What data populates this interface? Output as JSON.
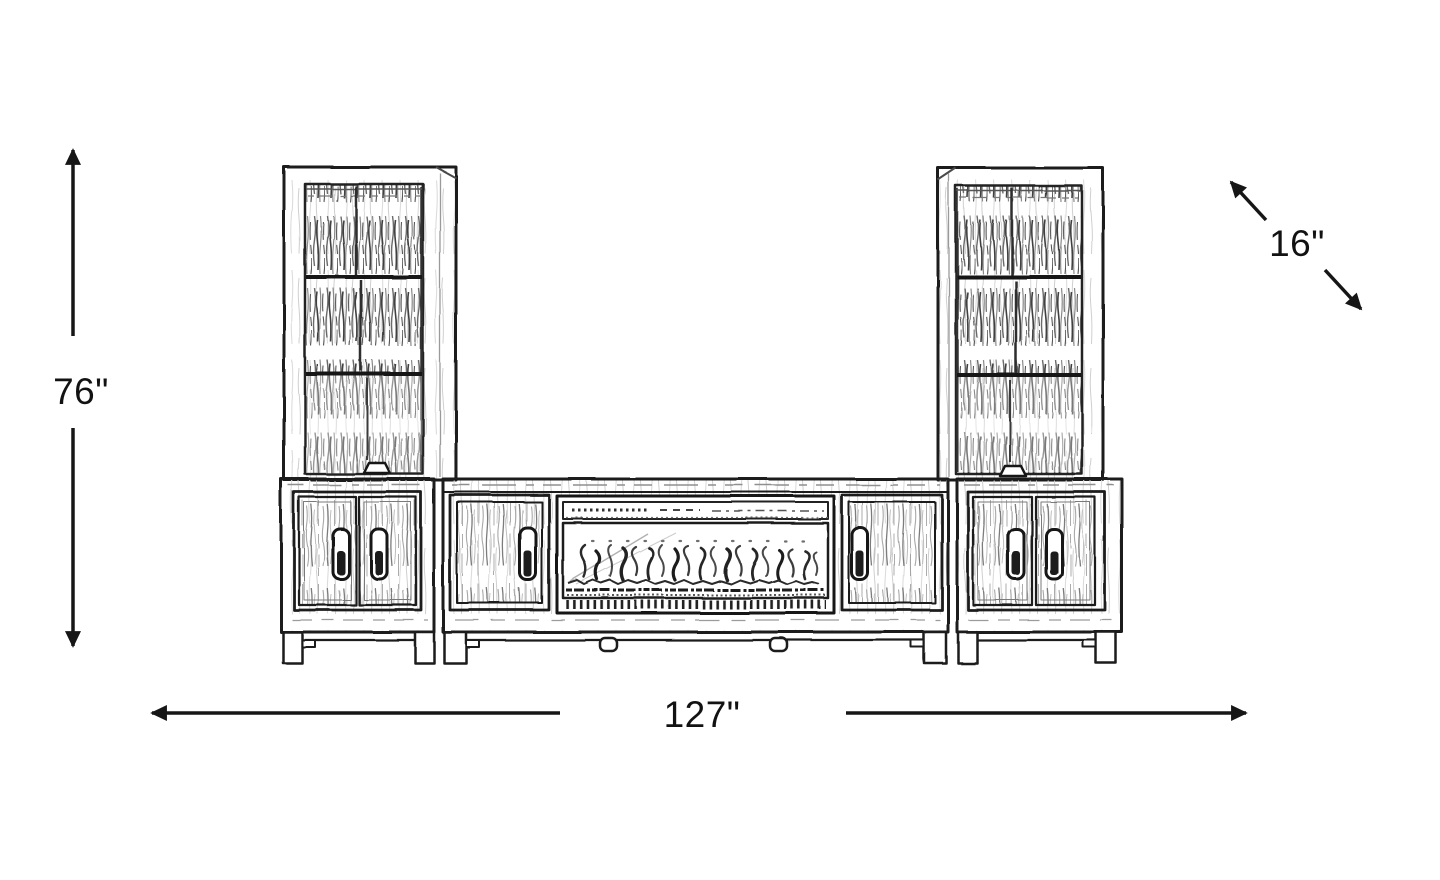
{
  "dimensions": {
    "height_label": "76\"",
    "width_label": "127\"",
    "depth_label": "16\""
  },
  "colors": {
    "background": "#ffffff",
    "line": "#1b1b1b",
    "text": "#121212"
  }
}
